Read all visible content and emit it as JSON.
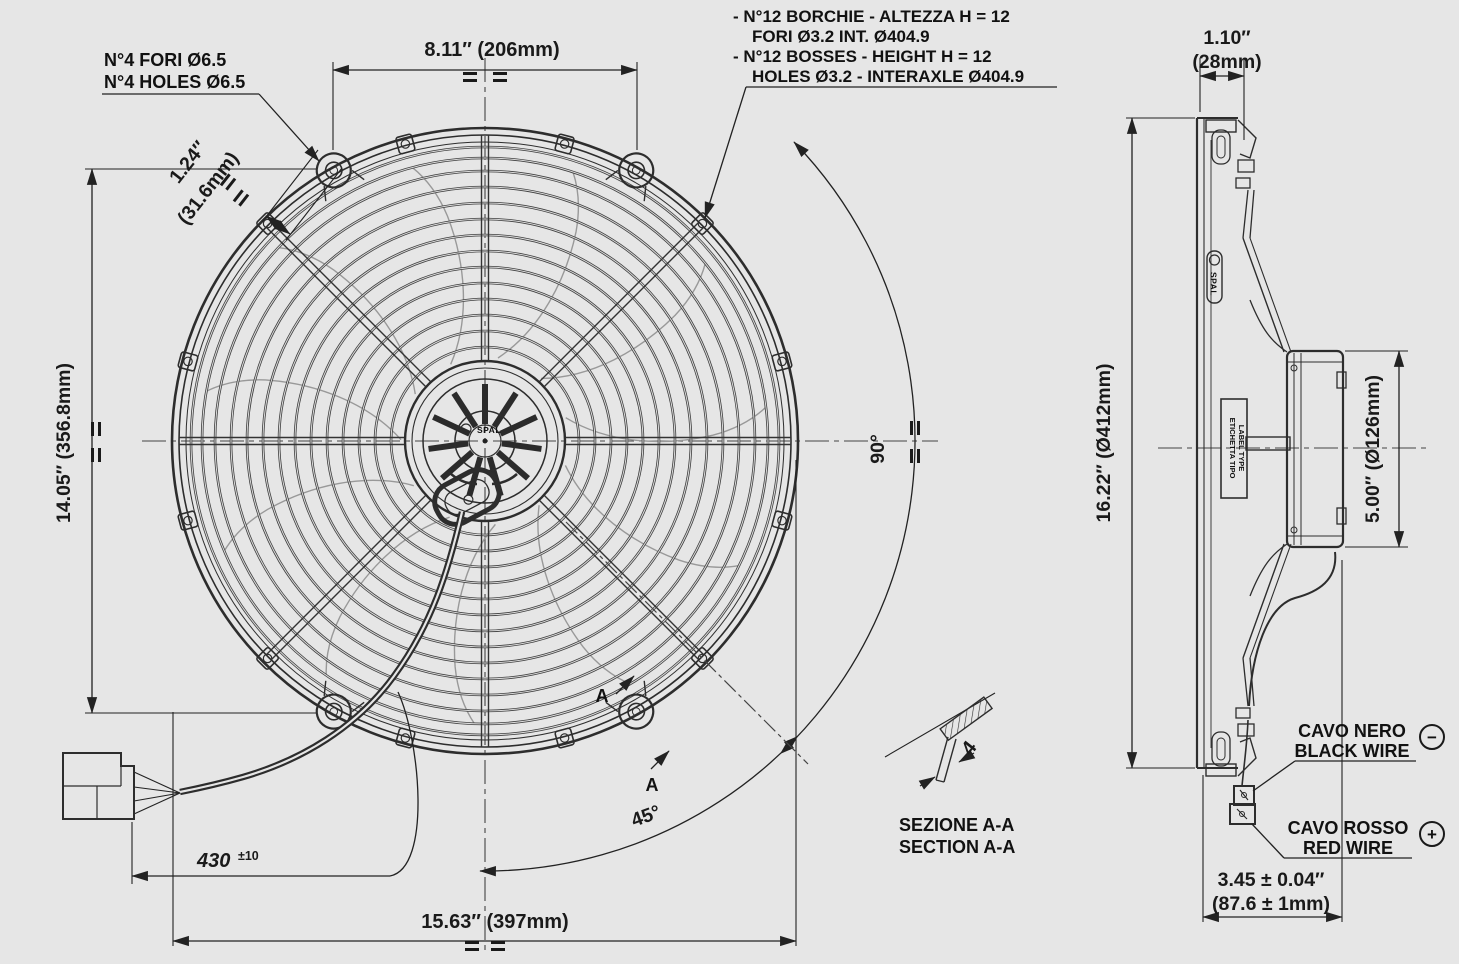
{
  "colors": {
    "background": "#e6e6e6",
    "line": "#2d2d2d",
    "text": "#111111"
  },
  "drawing": {
    "front": {
      "holes_label": {
        "line1": "N°4 FORI Ø6.5",
        "line2": "N°4 HOLES Ø6.5"
      },
      "bosses_label": {
        "line1": "- N°12 BORCHIE - ALTEZZA H = 12",
        "line2": "FORI Ø3.2 INT. Ø404.9",
        "line3": "- N°12 BOSSES - HEIGHT H = 12",
        "line4": "HOLES Ø3.2 - INTERAXLE Ø404.9"
      },
      "dim_top": "8.11″ (206mm)",
      "dim_left": "14.05″ (356.8mm)",
      "dim_hole_offset": {
        "line1": "1.24″",
        "line2": "(31.6mm)"
      },
      "dim_overall": "15.63″ (397mm)",
      "dim_cable": {
        "value": "430",
        "tolerance": "±10"
      },
      "angle_90": "90°",
      "angle_45": "45°",
      "section_letter": "A",
      "hub_logo": "SPAL"
    },
    "section": {
      "title_line1": "SEZIONE A-A",
      "title_line2": "SECTION A-A",
      "thickness": "4"
    },
    "side": {
      "dim_depth": {
        "line1": "1.10″",
        "line2": "(28mm)"
      },
      "dim_diameter": "16.22″ (Ø412mm)",
      "dim_motor": "5.00″ (Ø126mm)",
      "dim_total": {
        "line1": "3.45 ± 0.04″",
        "line2": "(87.6 ± 1mm)"
      },
      "label_type": {
        "line1": "ETICHETTA TIPO",
        "line2": "LABEL TYPE"
      },
      "logo": "SPAL",
      "black_wire": {
        "line1": "CAVO NERO",
        "line2": "BLACK WIRE",
        "polarity": "−"
      },
      "red_wire": {
        "line1": "CAVO ROSSO",
        "line2": "RED WIRE",
        "polarity": "+"
      }
    }
  }
}
